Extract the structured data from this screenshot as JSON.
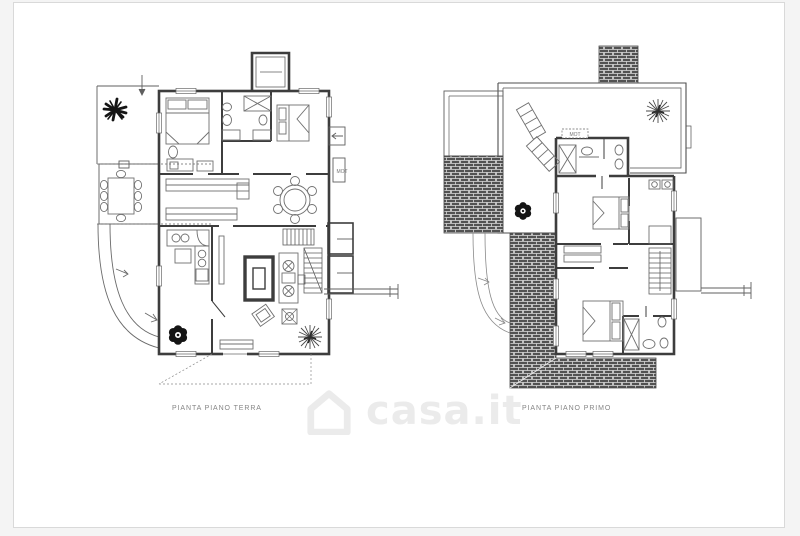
{
  "page": {
    "background_color": "#f4f4f4",
    "panel_background": "#ffffff",
    "panel_border_color": "#d9d9d9"
  },
  "watermark": {
    "brand_text": "casa.it",
    "icon": "house-outline-icon",
    "color": "#ebebeb"
  },
  "drawing": {
    "wall_color": "#3d3d3d",
    "thin_line_color": "#5f5f5f",
    "furniture_color": "#707070",
    "hatch_dark": "#525252",
    "hatch_mortar": "#dcdcdc",
    "plant_dark_color": "#151515",
    "plant_gray_color": "#4a4a4a",
    "label_color": "#858585"
  },
  "plans": [
    {
      "id": "ground-floor",
      "label": "PIANTA PIANO TERRA",
      "annotations": [
        {
          "label": "MOT"
        }
      ]
    },
    {
      "id": "first-floor",
      "label": "PIANTA PIANO PRIMO",
      "annotations": [
        {
          "label": "MOT"
        }
      ]
    }
  ]
}
